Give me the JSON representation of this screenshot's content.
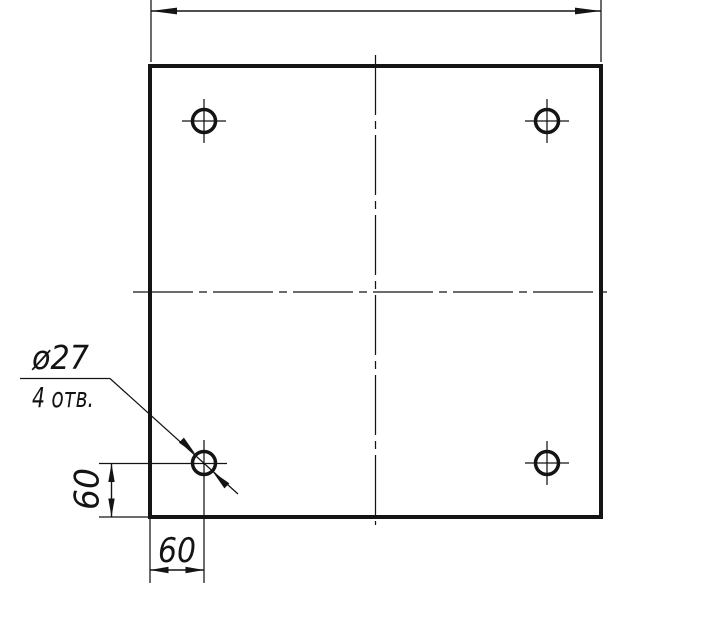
{
  "drawing": {
    "callout": {
      "diameter_label": "ø27",
      "holes_count_label": "4 отв."
    },
    "dims": {
      "vertical_offset_label": "60",
      "horizontal_offset_label": "60"
    },
    "depicted_values": {
      "hole_diameter": 27,
      "hole_count": 4,
      "corner_offset_x": 60,
      "corner_offset_y": 60
    },
    "colors": {
      "ink": "#141414",
      "paper": "#ffffff"
    }
  }
}
